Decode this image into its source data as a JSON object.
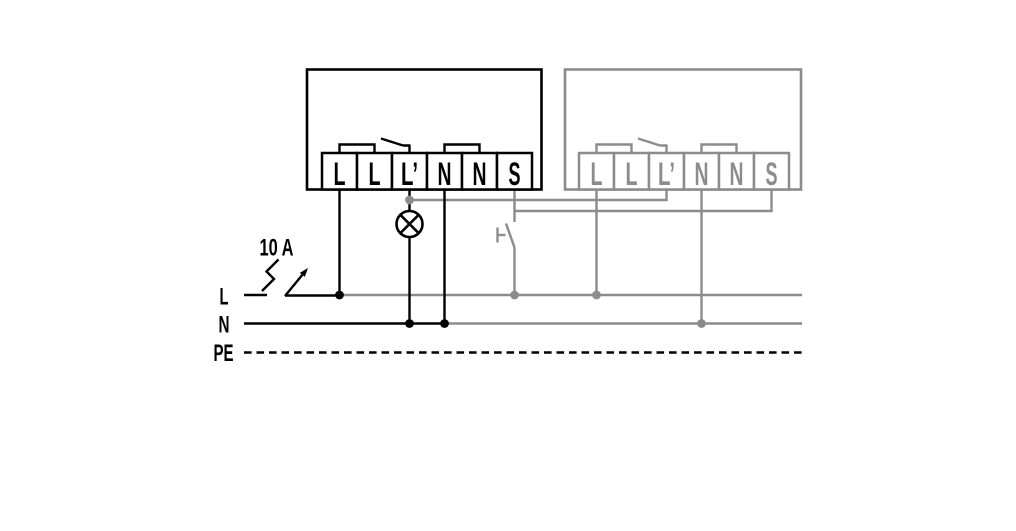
{
  "diagram": {
    "colors": {
      "primary": "#000000",
      "secondary": "#8c8c8c",
      "background": "#ffffff"
    },
    "device_left": {
      "name": "device-1",
      "terminals": [
        "L",
        "L",
        "L’",
        "N",
        "N",
        "S"
      ]
    },
    "device_right": {
      "name": "device-2",
      "terminals": [
        "L",
        "L",
        "L’",
        "N",
        "N",
        "S"
      ]
    },
    "bus": {
      "labels": [
        "L",
        "N",
        "PE"
      ]
    },
    "breaker": {
      "label": "10 A"
    },
    "icons": {
      "lamp": "lamp-icon",
      "breaker": "circuit-breaker-icon",
      "push_button": "push-button-icon",
      "relay_contact": "relay-contact-icon"
    }
  }
}
